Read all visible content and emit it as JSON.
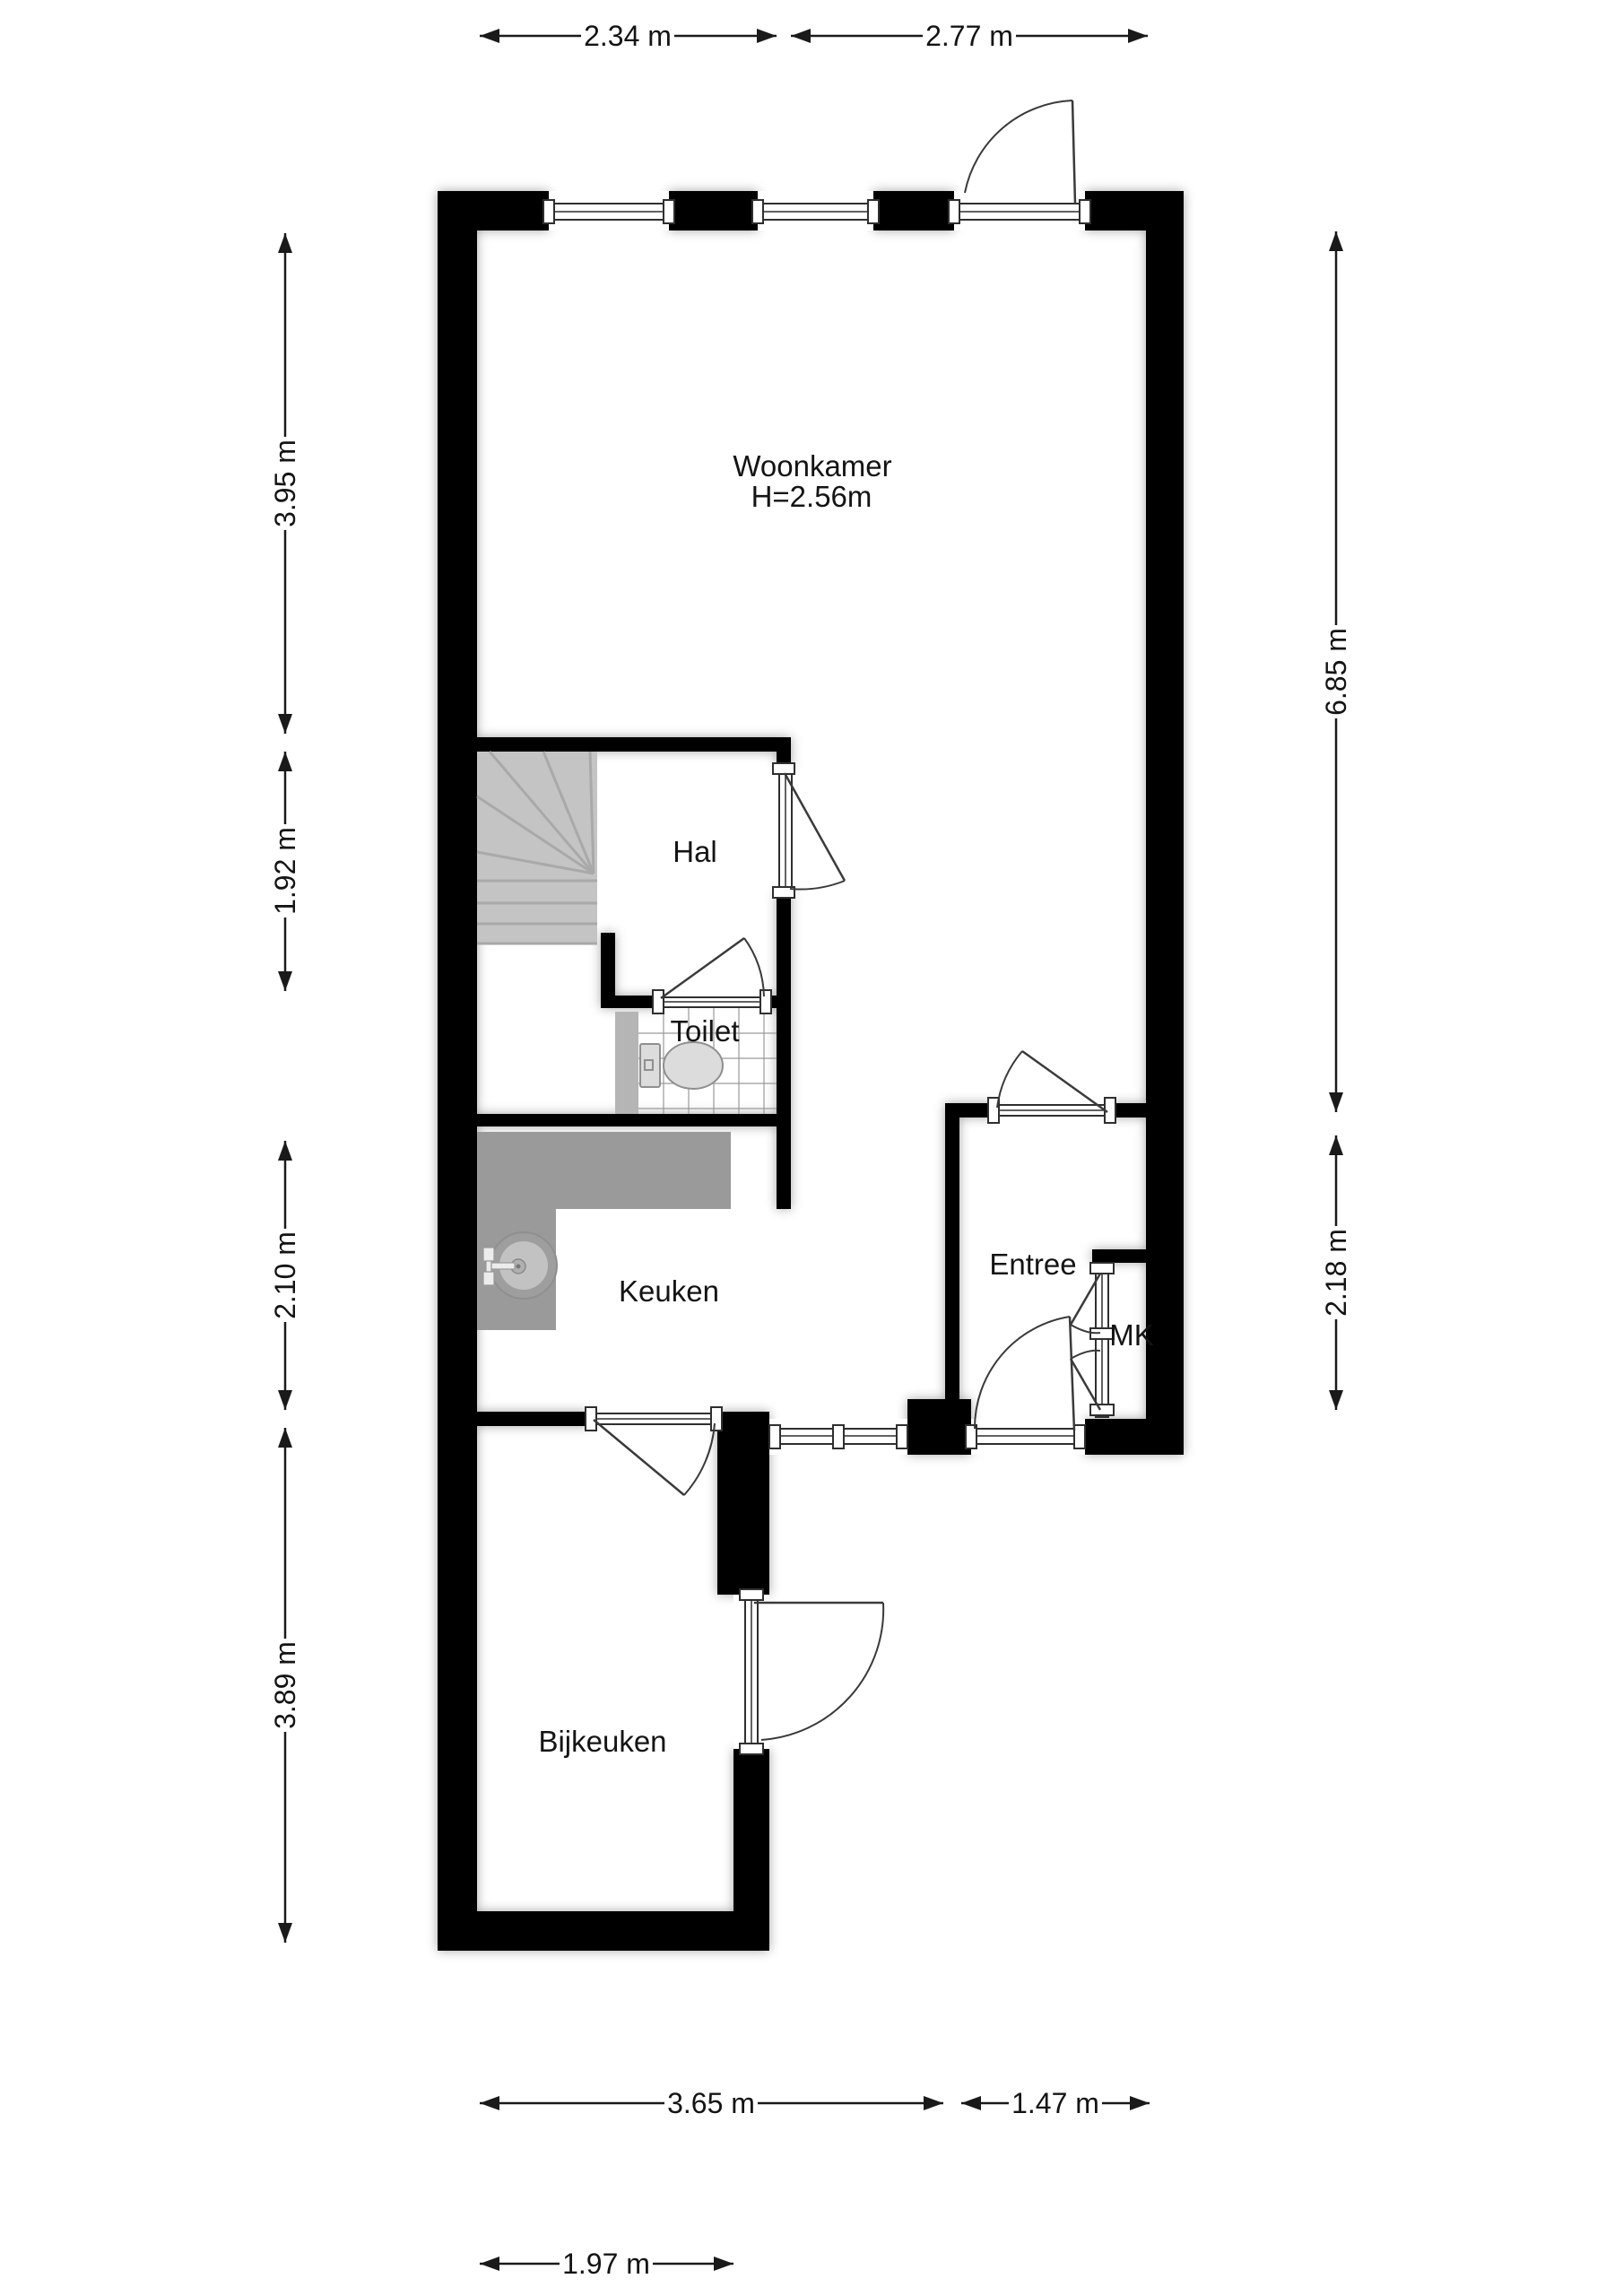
{
  "plan": {
    "type": "floorplan",
    "floor": "ground-floor",
    "language": "nl"
  },
  "rooms": {
    "woonkamer": {
      "label": "Woonkamer",
      "ceiling_height": "H=2.56m"
    },
    "hal": {
      "label": "Hal"
    },
    "toilet": {
      "label": "Toilet"
    },
    "keuken": {
      "label": "Keuken"
    },
    "entree": {
      "label": "Entree"
    },
    "mk": {
      "label": "MK"
    },
    "bijkeuken": {
      "label": "Bijkeuken"
    }
  },
  "dims": {
    "top": [
      {
        "label": "2.34 m"
      },
      {
        "label": "2.77 m"
      }
    ],
    "left": [
      {
        "label": "3.95 m"
      },
      {
        "label": "1.92 m"
      },
      {
        "label": "2.10 m"
      },
      {
        "label": "3.89 m"
      }
    ],
    "right": [
      {
        "label": "6.85 m"
      },
      {
        "label": "2.18 m"
      }
    ],
    "bottom": [
      {
        "label": "3.65 m"
      },
      {
        "label": "1.47 m"
      },
      {
        "label": "1.97 m"
      }
    ]
  },
  "colors": {
    "wall": "#000000",
    "counter": "#9a9a9a",
    "stairs": "#c4c4c4",
    "stair_lines": "#a9a9a9",
    "partition": "#b5b5b5",
    "fixture_fill": "#dcdcdc",
    "fixture_stroke": "#8f8f8f",
    "tile_grid": "#9a9a9a",
    "sink_outer": "#9e9e9e",
    "sink_inner": "#c2c2c2",
    "dim_line": "#1a1a1a"
  }
}
